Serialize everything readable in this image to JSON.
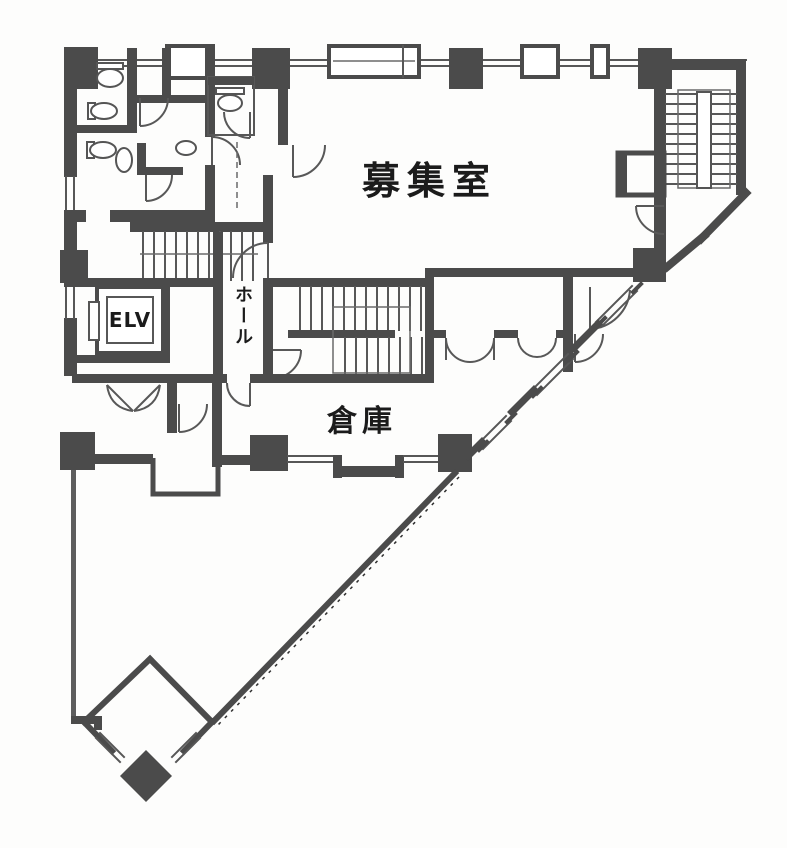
{
  "document": {
    "type": "scanned-architectural-floor-plan",
    "labels": {
      "main_room": "募集室",
      "storage": "倉庫",
      "elevator": "ELV",
      "hall": "ホール"
    },
    "colors": {
      "wall": "#4b4b4b",
      "line": "#575757",
      "paper": "#fdfdfc",
      "text": "#1b1b1b"
    }
  }
}
